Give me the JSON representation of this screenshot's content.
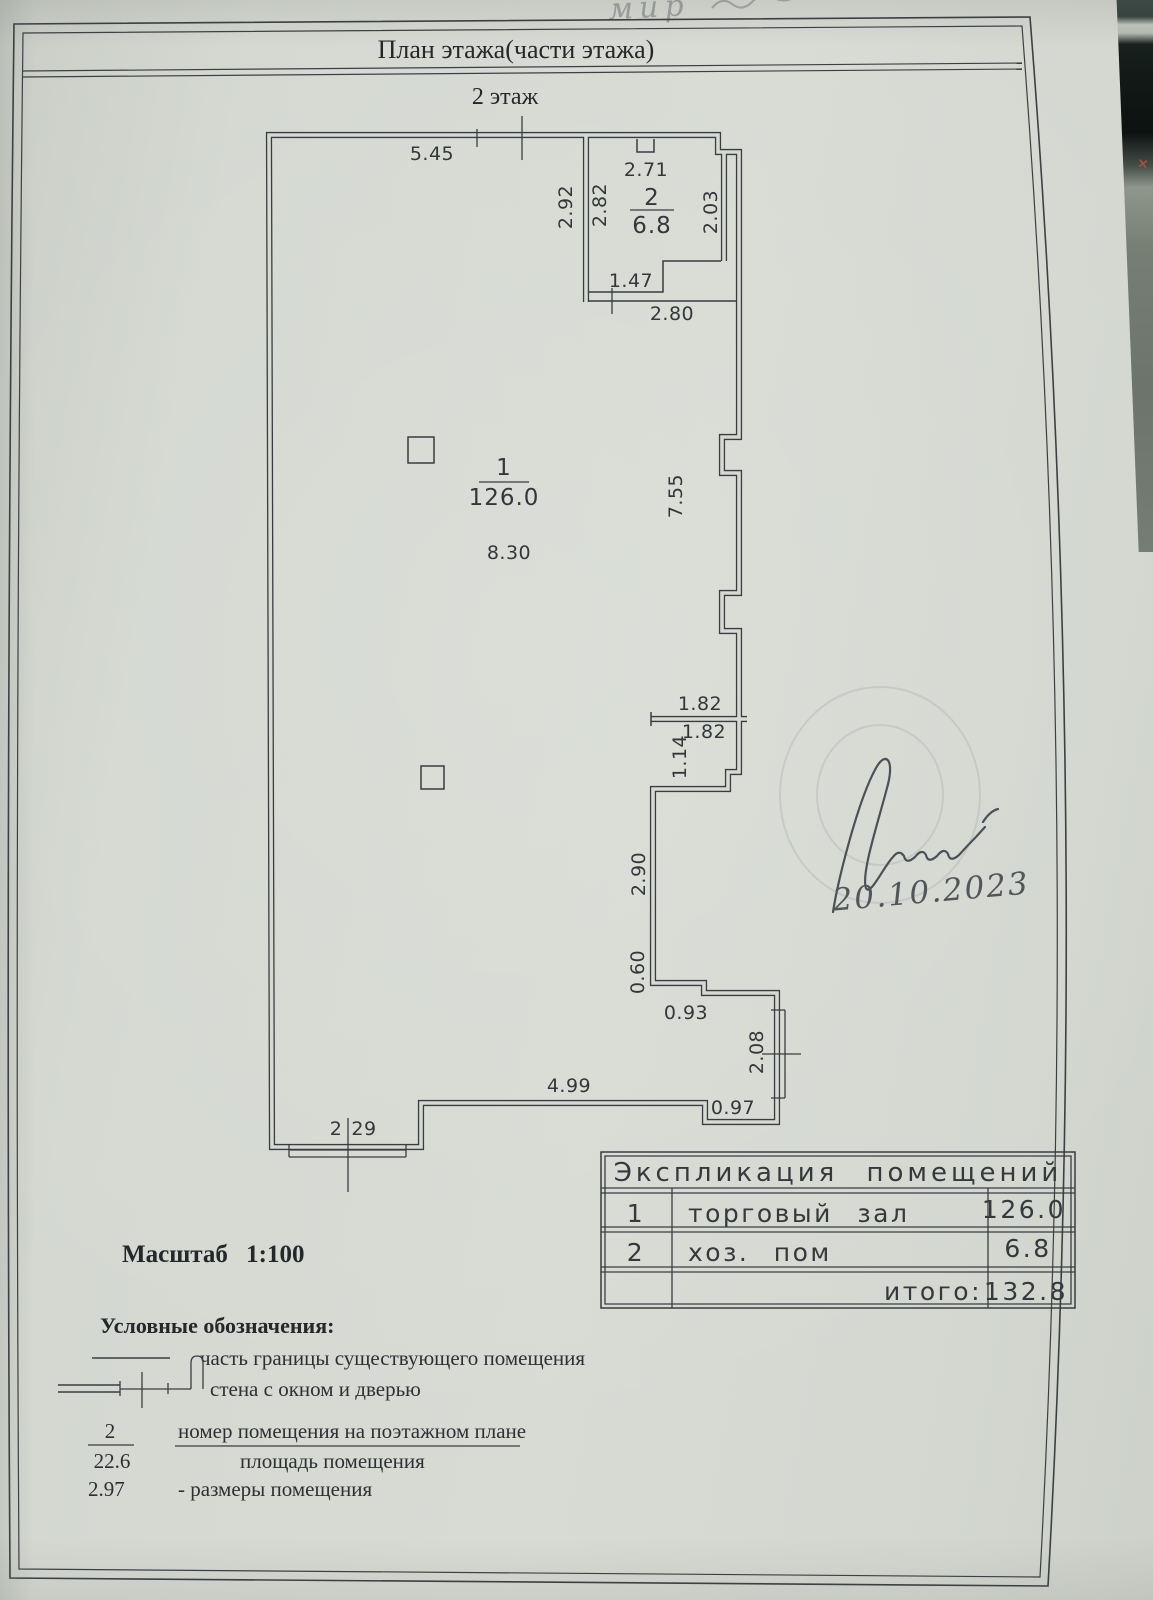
{
  "colors": {
    "paper": "#d6dad3",
    "ink": "#393d40",
    "signature_ink": "#4b5157",
    "marker_red": "#a94f46"
  },
  "page": {
    "title": "План этажа(части этажа)",
    "floor_label": "2 этаж",
    "scale_label": "Масштаб 1:100",
    "handwriting_top": "мир",
    "signature_date": "20.10.2023"
  },
  "plan": {
    "rooms": {
      "room1": {
        "number": "1",
        "area": "126.0"
      },
      "room2": {
        "number": "2",
        "area": "6.8"
      }
    },
    "dims": {
      "top_wall": "5.45",
      "room2_top": "2.71",
      "room2_left_outer": "2.92",
      "room2_left_inner": "2.82",
      "room2_right": "2.03",
      "room2_door": "1.47",
      "room2_bottom": "2.80",
      "room1_width": "8.30",
      "room1_right": "7.55",
      "partition_top": "1.82",
      "partition_bottom": "1.82",
      "partition_height": "1.14",
      "wall_lower_right": "2.90",
      "wall_060": "0.60",
      "wall_093": "0.93",
      "window_right": "2.08",
      "bottom_wall": "4.99",
      "bottom_step": "0.97",
      "window_bottom_left_a": "2",
      "window_bottom_left_b": "29"
    }
  },
  "table": {
    "title": "Экспликация помещений",
    "rows": [
      {
        "num": "1",
        "name": "торговый зал",
        "area": "126.0"
      },
      {
        "num": "2",
        "name": "хоз. пом",
        "area": "6.8"
      }
    ],
    "total_label": "итого:",
    "total_value": "132.8"
  },
  "legend": {
    "title": "Условные обозначения:",
    "boundary_label": "часть границы существующего помещения",
    "wall_label": "стена с окном и дверью",
    "number_fraction_top": "2",
    "number_fraction_bottom": "22.6",
    "number_label": "номер помещения на поэтажном плане",
    "area_label": "площадь помещения",
    "size_example": "2.97",
    "size_label": "- размеры помещения"
  }
}
